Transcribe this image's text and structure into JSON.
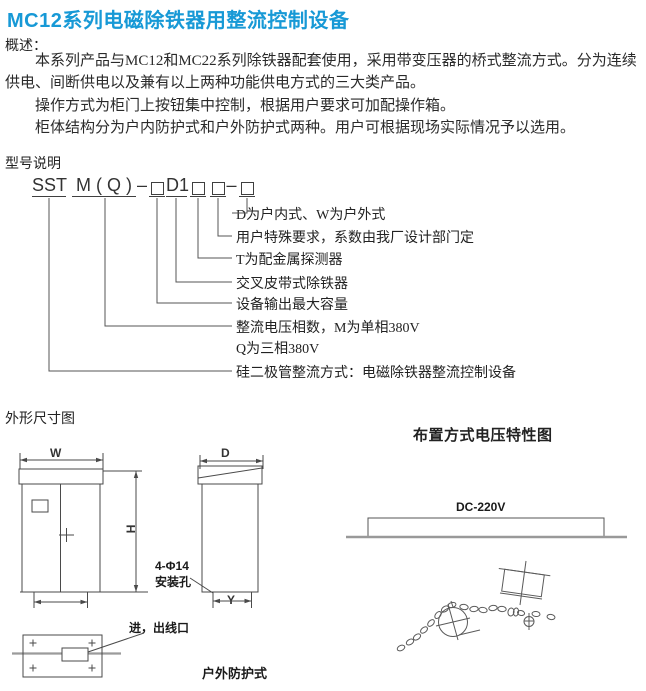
{
  "title": "MC12系列电磁除铁器用整流控制设备",
  "colors": {
    "accent": "#1799d6",
    "line": "#4a4a4a",
    "gray_line": "#999999"
  },
  "overview": {
    "heading": "概述：",
    "paragraphs": [
      "本系列产品与MC12和MC22系列除铁器配套使用，采用带变压器的桥式整流方式。分为连续供电、间断供电以及兼有以上两种功能供电方式的三大类产品。",
      "操作方式为柜门上按钮集中控制，根据用户要求可加配操作箱。",
      "柜体结构分为户内防护式和户外防护式两种。用户可根据现场实际情况予以选用。"
    ]
  },
  "model": {
    "heading": "型号说明",
    "code": {
      "seg1": "SST",
      "seg2": "M ( Q )",
      "dash1": "–",
      "seg3": "D1",
      "dash2": "–"
    },
    "labels": [
      "D为户内式、W为户外式",
      "用户特殊要求，系数由我厂设计部门定",
      "T为配金属探测器",
      "交叉皮带式除铁器",
      "设备输出最大容量",
      "整流电压相数，M为单相380V",
      "Q为三相380V",
      "硅二极管整流方式：电磁除铁器整流控制设备"
    ]
  },
  "dimensions": {
    "heading": "外形尺寸图",
    "front": {
      "width_label": "W",
      "height_label": "H"
    },
    "side": {
      "depth_label": "D",
      "foot_label": "Y",
      "hole_label_line1": "4-Φ14",
      "hole_label_line2": "安装孔"
    },
    "bottom": {
      "port_label": "进，出线口"
    },
    "caption": "户外防护式"
  },
  "layout_chart": {
    "heading": "布置方式电压特性图",
    "voltage_label": "DC-220V"
  }
}
